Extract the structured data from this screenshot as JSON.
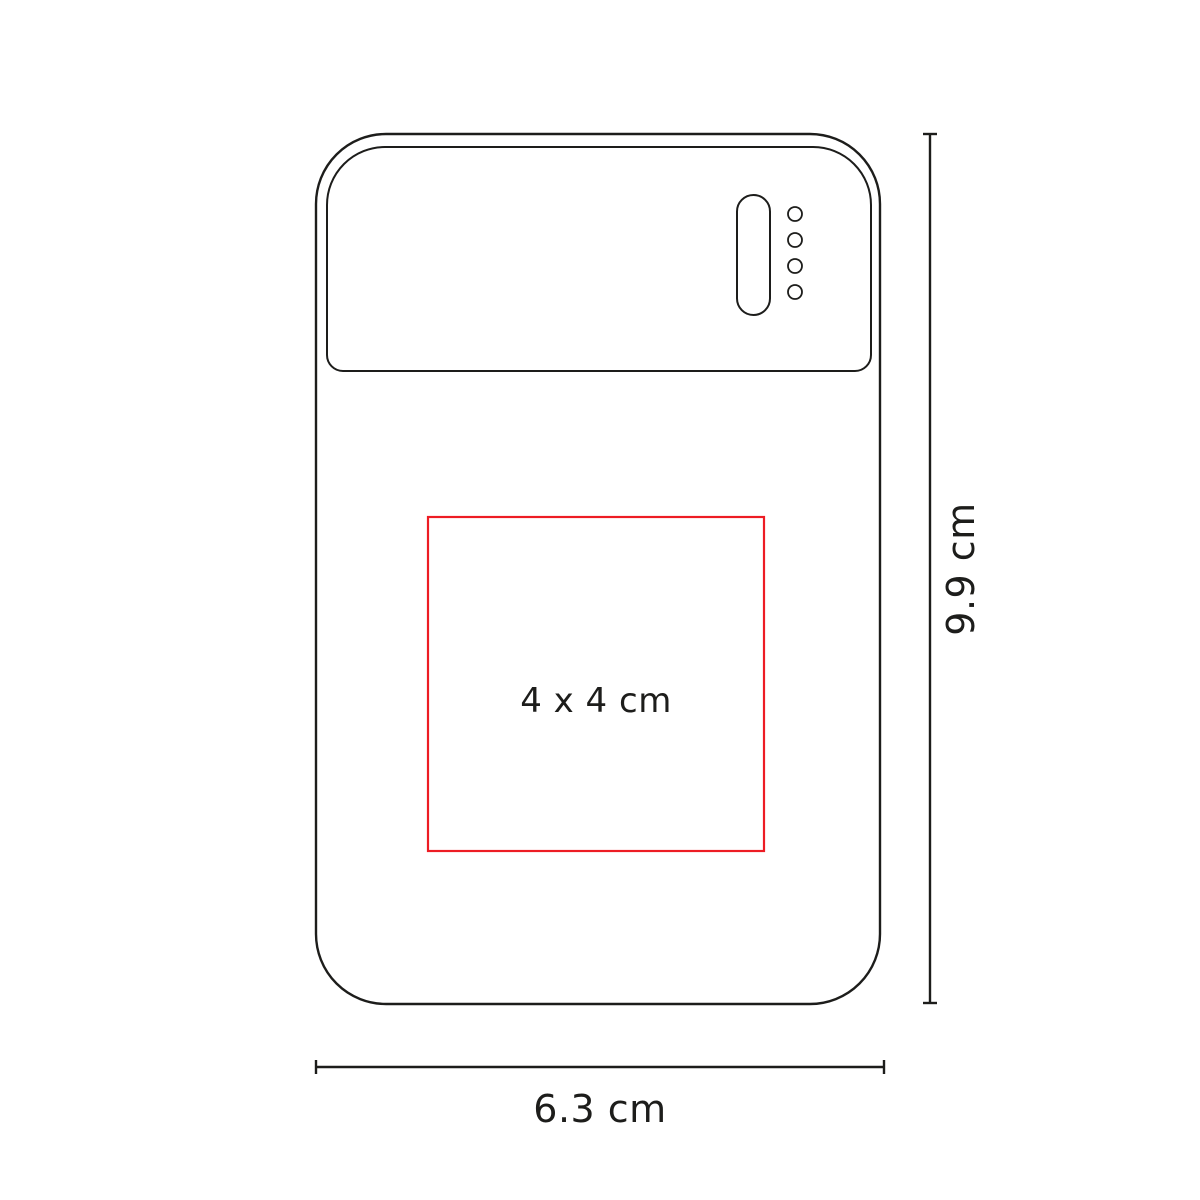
{
  "diagram": {
    "description": "power bank front view print-area diagram",
    "print_area": {
      "label": "4 x 4 cm",
      "border_color": "#ed1c24"
    },
    "dimensions": {
      "height_label": "9.9 cm",
      "width_label": "6.3 cm"
    },
    "leds": {
      "count": 4
    },
    "colors": {
      "outline": "#1d1d1b",
      "text": "#1d1d1b",
      "background": "#ffffff"
    }
  }
}
